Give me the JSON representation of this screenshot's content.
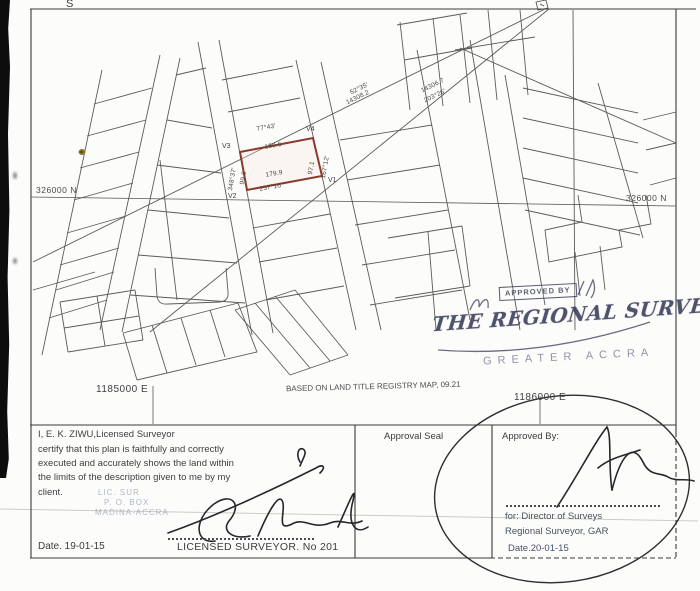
{
  "colors": {
    "plot_outline": "#8a3a2c",
    "stamp_ink": "#3a3e56",
    "map_line": "#4a4a4a"
  },
  "map": {
    "corner_mark": "S",
    "grid": {
      "north_left": "326000 N",
      "north_right": "326000 N",
      "east_left": "1185000 E",
      "east_right": "1186000 E"
    },
    "note": "BASED ON LAND TITLE REGISTRY MAP, 09.21",
    "plot": {
      "v1": "V1",
      "v2": "V2",
      "v3": "V3",
      "v4": "V4",
      "top_bearing": "77°43'",
      "top_distance": "160.6",
      "bottom_distance": "179.9",
      "bottom_bearing": "257°16'",
      "left_bearing": "348°37'",
      "left_distance": "99.6",
      "right_distance": "97.1",
      "right_bearing": "167°12'"
    },
    "traverse": {
      "line1_bearing": "52°35'",
      "line1_distance": "14308.2",
      "line2_distance": "14306.7",
      "line2_bearing": "203°26'"
    }
  },
  "stamps": {
    "approved_by": "APPROVED BY",
    "title": "THE REGIONAL SURVEYOR",
    "region": "GREATER ACCRA"
  },
  "certificate": {
    "lines": [
      "I,  E. K.  ZIWU,Licensed Surveyor",
      "certify that this plan is faithfully and correctly",
      "executed and accurately shows the land within",
      "the limits of the description given to me by my",
      "client."
    ],
    "stamp_faint": [
      "LIC. SUR",
      "P. O. BOX",
      "MADINA-ACCRA"
    ],
    "date": "Date.  19-01-15",
    "license": "LICENSED SURVEYOR. No 201"
  },
  "approval": {
    "seal_label": "Approval Seal",
    "approved_by": "Approved By:",
    "for_line": "for: Director of Surveys",
    "office": "Regional Surveyor, GAR",
    "date": "Date.20-01-15"
  }
}
